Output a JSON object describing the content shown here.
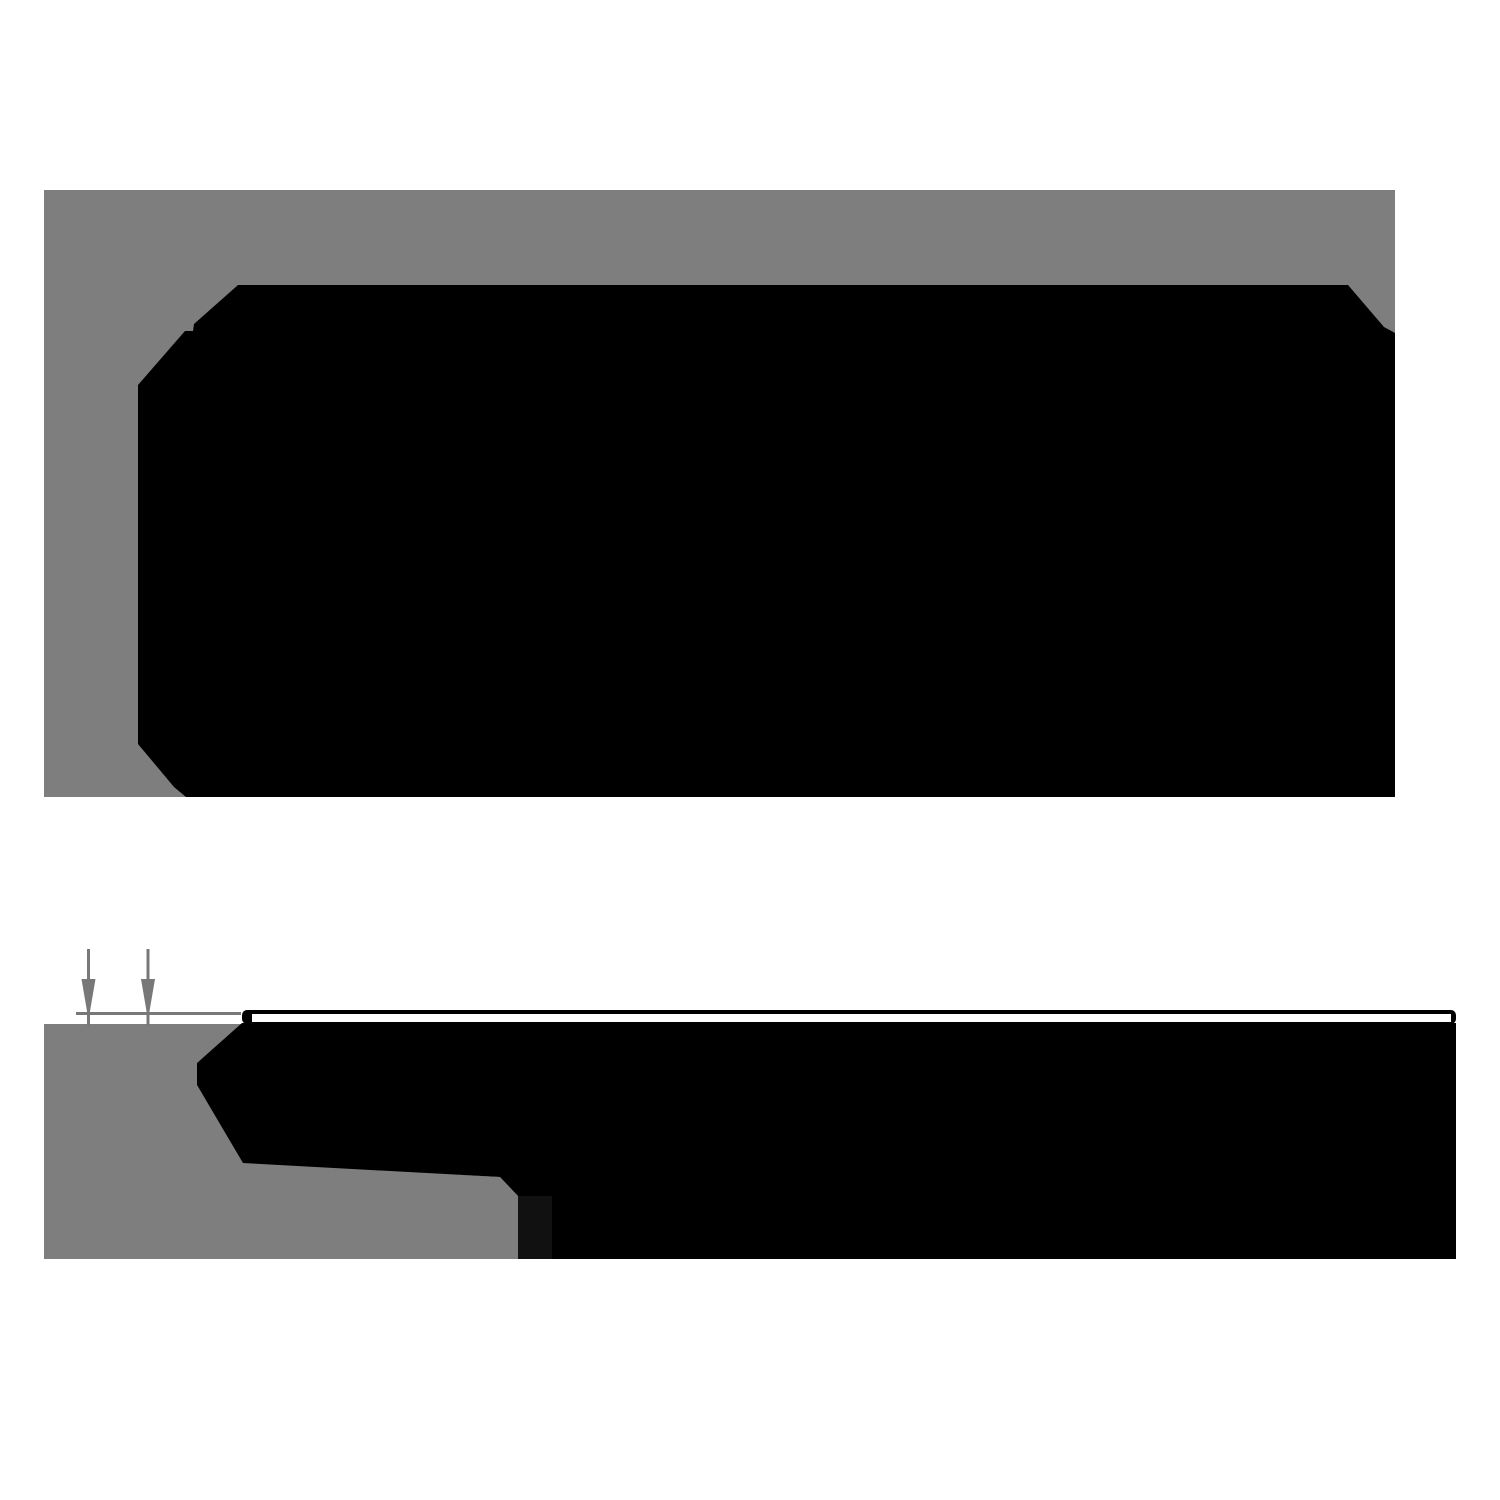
{
  "canvas": {
    "width": 1500,
    "height": 1500,
    "background": "#ffffff"
  },
  "colors": {
    "backdrop": "#7e7e7e",
    "ink": "#000000",
    "dimension": "#787878",
    "shadow_strip": "#111111",
    "highlight": "#ffffff"
  },
  "figures": {
    "top_view": {
      "backdrop": {
        "x": 44,
        "y": 190,
        "w": 1351,
        "h": 607
      },
      "tile_points": "138,385 185,331 193,331 194,324 238,285 1348,285 1384,327 1395,333 1395,797 186,797 174,787 138,744"
    },
    "profile_view": {
      "underlay_points": "44,1024 242,1024 197,1063 197,1085 243,1162 500,1177 518,1196 518,1259 44,1259",
      "body_points": "197,1063 242,1023 1456,1023 1456,1259 518,1259 518,1196 500,1177 243,1163 197,1085",
      "shadow_strip": {
        "x": 518,
        "y": 1196,
        "w": 34,
        "h": 63
      },
      "top_layer_outline": {
        "x": 242,
        "y": 1010,
        "w": 1214,
        "h": 14,
        "rx": 5
      },
      "top_layer_face": {
        "x": 252,
        "y": 1014,
        "w": 1199,
        "h": 8
      },
      "dimension_line": {
        "x": 76,
        "y": 1012,
        "w": 165,
        "h": 3
      },
      "arrows": [
        {
          "shaft": {
            "x": 87,
            "y": 949,
            "w": 3,
            "h": 77
          },
          "head_points": "81.5,979 95.5,979 88.5,1020"
        },
        {
          "shaft": {
            "x": 146.5,
            "y": 949,
            "w": 3,
            "h": 77
          },
          "head_points": "141,979 155,979 148,1020"
        }
      ]
    }
  }
}
